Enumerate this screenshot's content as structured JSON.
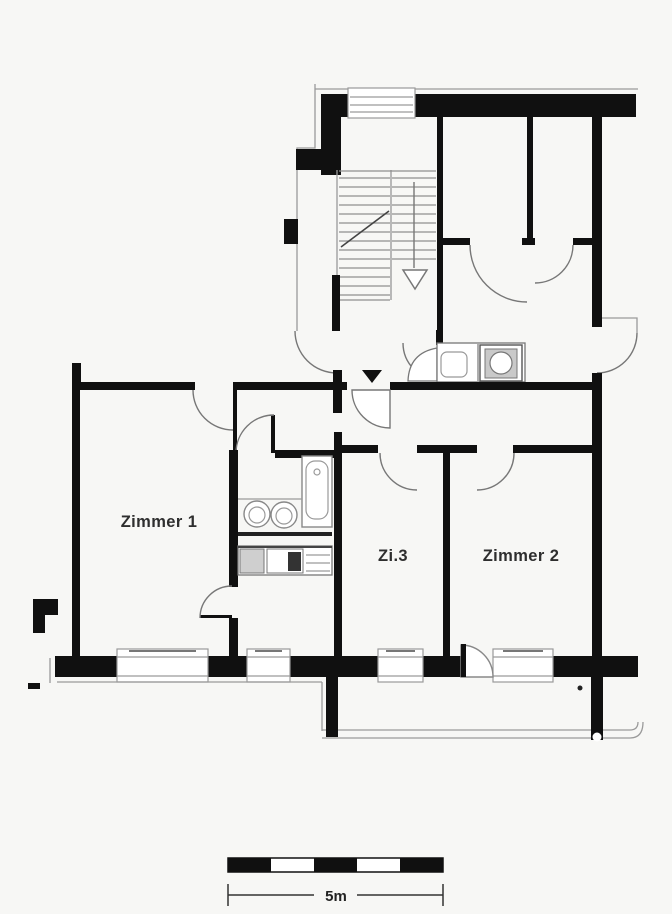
{
  "floorplan": {
    "type": "apartment-floor-plan",
    "rooms": [
      {
        "label": "Zimmer 1"
      },
      {
        "label": "Zi.3"
      },
      {
        "label": "Zimmer 2"
      }
    ],
    "scale_bar": {
      "label": "5m"
    },
    "colors": {
      "background": "#f7f7f5",
      "walls": "#101010",
      "thin_lines": "#9a9a9a",
      "label_text": "#2e2e2e"
    }
  }
}
